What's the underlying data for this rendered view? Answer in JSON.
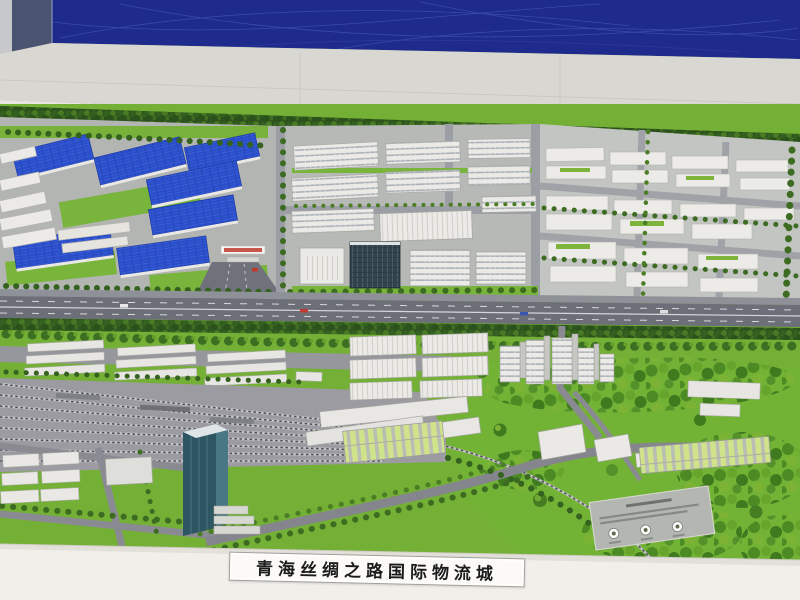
{
  "title_plaque": {
    "text": "青海丝绸之路国际物流城"
  },
  "palette": {
    "backdrop_blue": "#1e2a8c",
    "backdrop_line_blue": "#4d63c9",
    "wall_white": "#d9d7d2",
    "base_white": "#f1efea",
    "grass": "#74af36",
    "grass_bright": "#72b335",
    "tree_dark": "#2f5520",
    "tree_light": "#67a42c",
    "roof_blue": "#2b4fca",
    "building_white": "#ecebe7",
    "glass_dark": "#33434c",
    "glass_tower_teal": "#2e5562",
    "road_gray": "#8e9098",
    "highway_gray": "#6d6f78",
    "banner_red": "#c0392e"
  }
}
